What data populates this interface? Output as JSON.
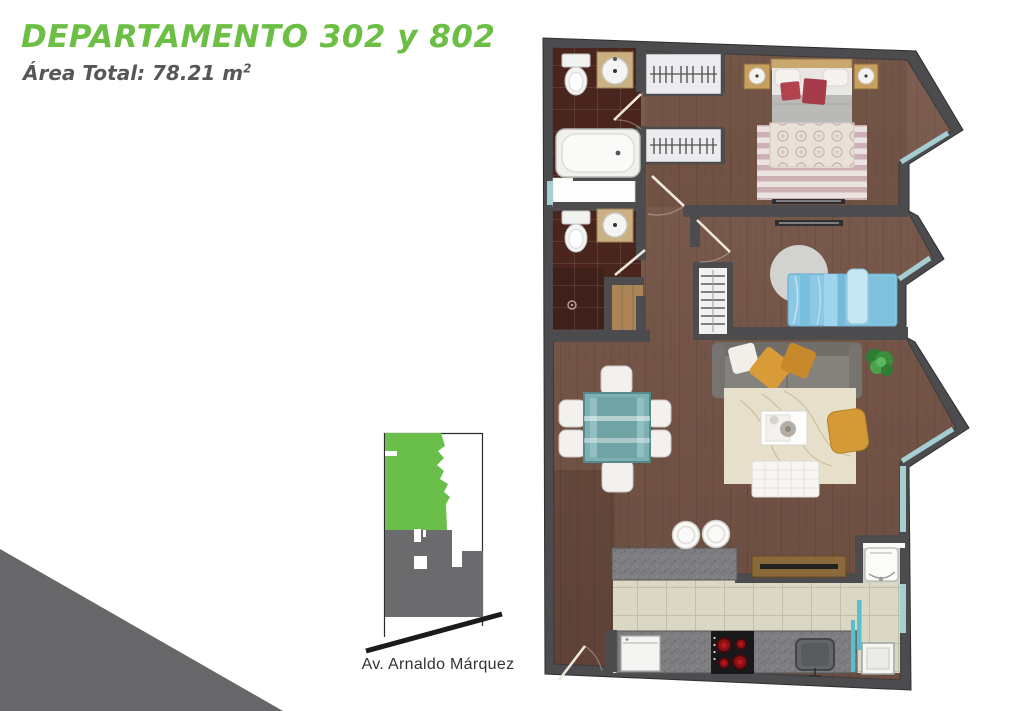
{
  "header": {
    "title": "DEPARTAMENTO 302 y 802",
    "area_label": "Área Total: 78.21 m",
    "area_superscript": "2"
  },
  "site_map": {
    "street_label": "Av. Arnaldo Márquez"
  },
  "colors": {
    "title_green": "#6cbe44",
    "subtitle_gray": "#57575a",
    "wall": "#4c4c4f",
    "wood_floor": "#755648",
    "bath_tile": "#4a251d",
    "kitchen_tile": "#d9d6c4",
    "glass_teal": "#a5ced2",
    "kitchen_door_teal": "#57c0cb",
    "granite": "#7e7e80",
    "site_green": "#6abf4b",
    "site_gray": "#6b6b6e",
    "street_line": "#1b1b1b",
    "corner_triangle": "#67676a"
  },
  "floor_plan": {
    "features": [
      "bathtub",
      "toilet",
      "vanity-sink",
      "duct",
      "wardrobe",
      "double-bed",
      "nightstand-lamp",
      "striped-rug",
      "single-bed",
      "round-rug",
      "ladder-shelf",
      "sofa",
      "throw-pillows",
      "plant",
      "area-rug",
      "coffee-table",
      "tufted-bench",
      "pouf",
      "dining-table",
      "dining-chairs",
      "bar-stools",
      "tv-console",
      "kitchen-peninsula",
      "kitchen-counter",
      "washer",
      "cooktop",
      "kitchen-sink",
      "sliding-teal-door",
      "fridge",
      "water-heater",
      "entrance-door",
      "bay-windows"
    ]
  }
}
